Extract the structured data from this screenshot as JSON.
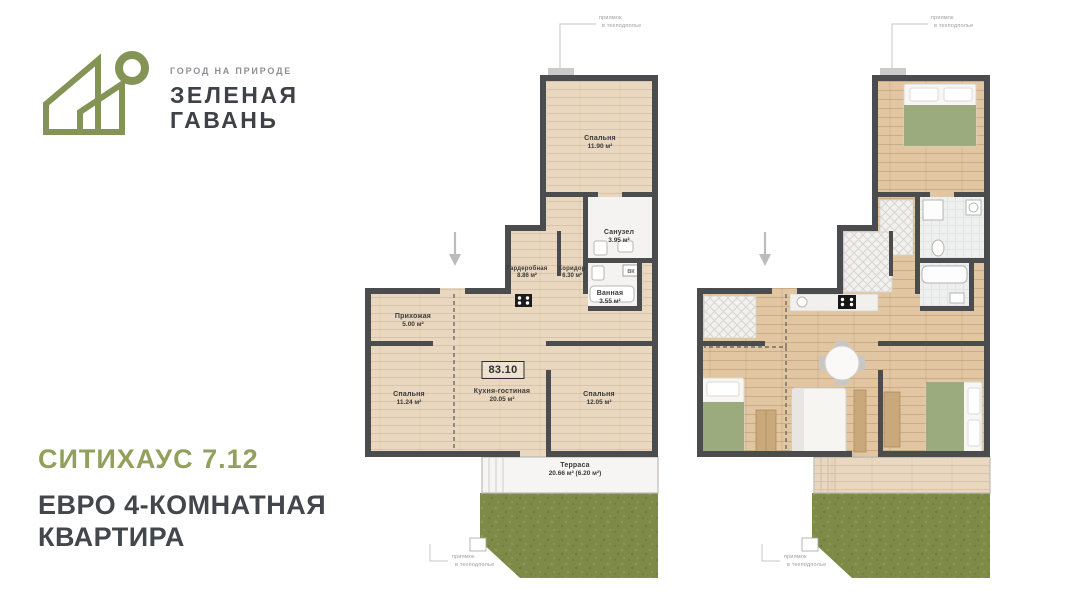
{
  "brand": {
    "tagline": "ГОРОД НА ПРИРОДЕ",
    "name_line1": "ЗЕЛЕНАЯ",
    "name_line2": "ГАВАНЬ"
  },
  "listing": {
    "plan_code": "СИТИХАУС 7.12",
    "title_line1": "ЕВРО 4-КОМНАТНАЯ",
    "title_line2": "КВАРТИРА"
  },
  "plan": {
    "total_area": "83.10",
    "rooms": [
      {
        "name": "Спальня",
        "area": "11.90 м²"
      },
      {
        "name": "Санузел",
        "area": "3.95 м²"
      },
      {
        "name": "Гардеробная",
        "area": "8.86 м²"
      },
      {
        "name": "Коридор",
        "area": "6.30 м²"
      },
      {
        "name": "Ванная",
        "area": "3.55 м²"
      },
      {
        "name": "Прихожая",
        "area": "5.00 м²"
      },
      {
        "name": "Кухня-гостиная",
        "area": "20.05 м²"
      },
      {
        "name": "Спальня",
        "area": "11.24 м²"
      },
      {
        "name": "Спальня",
        "area": "12.05 м²"
      },
      {
        "name": "Терраса",
        "area": "20.66 м² (6.20 м²)"
      }
    ],
    "annotation_line1": "приямок",
    "annotation_line2": "в техподполье",
    "vent_label": "ВК"
  },
  "colors": {
    "accent_green": "#93a05c",
    "logo_green": "#7d8f4e",
    "text_dark": "#43474c",
    "wall": "#4b4c4e",
    "floor_beige": "#e9d8bf",
    "wood": "#e1c6a1",
    "grass": "#7d8a48",
    "blanket_green": "#9cab7e"
  }
}
